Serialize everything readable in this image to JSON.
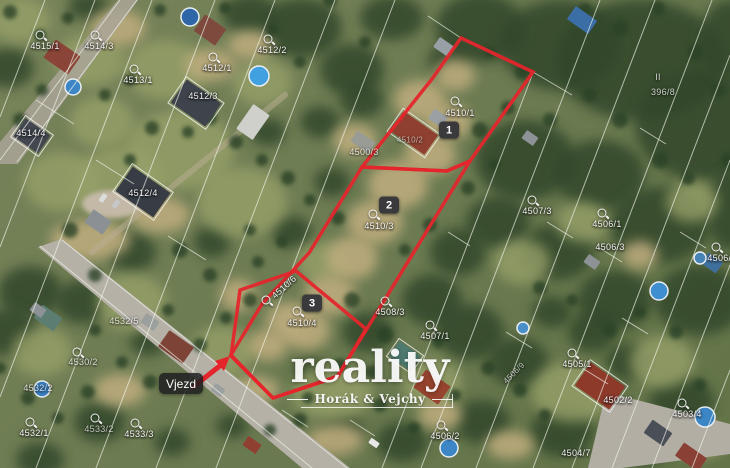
{
  "map": {
    "entrance_label": "Vjezd",
    "watermark": {
      "brand": "reality",
      "subtitle": "Horák & Vejchy"
    },
    "red_color": "#e4262c",
    "markers": [
      {
        "id": "1",
        "x": 449,
        "y": 130
      },
      {
        "id": "2",
        "x": 389,
        "y": 205
      },
      {
        "id": "3",
        "x": 312,
        "y": 303
      }
    ],
    "outlines": [
      {
        "points": "461,38 533,72 470,161 447,171 362,167 432,79"
      },
      {
        "points": "362,167 447,171 470,161 417,247 368,327 337,377 273,398 231,355 262,304 309,253"
      },
      {
        "points": "296,271 240,290 231,356 273,398 338,376 366,329"
      }
    ],
    "arrow": {
      "x1": 193,
      "y1": 387,
      "x2": 221,
      "y2": 365,
      "head": "230,356 215,361 224,371"
    },
    "parcel_labels": [
      {
        "text": "4515/1",
        "x": 45,
        "y": 46,
        "sym": [
          40,
          35
        ]
      },
      {
        "text": "4514/3",
        "x": 99,
        "y": 46,
        "sym": [
          95,
          35
        ]
      },
      {
        "text": "4513/1",
        "x": 138,
        "y": 80,
        "sym": [
          134,
          69
        ]
      },
      {
        "text": "4512/1",
        "x": 217,
        "y": 68,
        "sym": [
          213,
          57
        ]
      },
      {
        "text": "4512/2",
        "x": 272,
        "y": 50,
        "sym": [
          268,
          39
        ]
      },
      {
        "text": "4512/3",
        "x": 203,
        "y": 96
      },
      {
        "text": "4514/4",
        "x": 31,
        "y": 133
      },
      {
        "text": "4512/4",
        "x": 143,
        "y": 193
      },
      {
        "text": "4500/3",
        "x": 364,
        "y": 152,
        "op": 0.8
      },
      {
        "text": "4510/1",
        "x": 460,
        "y": 113,
        "sym": [
          455,
          101
        ]
      },
      {
        "text": "4510/2",
        "x": 410,
        "y": 140,
        "op": 0.6,
        "size": 8
      },
      {
        "text": "4510/3",
        "x": 379,
        "y": 226,
        "sym": [
          373,
          214
        ]
      },
      {
        "text": "4510/6",
        "x": 284,
        "y": 287,
        "rot": -42,
        "sym": [
          266,
          300
        ]
      },
      {
        "text": "4510/4",
        "x": 302,
        "y": 323,
        "sym": [
          297,
          311
        ]
      },
      {
        "text": "4508/3",
        "x": 390,
        "y": 312,
        "sym": [
          385,
          301
        ]
      },
      {
        "text": "4507/3",
        "x": 537,
        "y": 211,
        "sym": [
          532,
          200
        ]
      },
      {
        "text": "4506/1",
        "x": 607,
        "y": 224,
        "sym": [
          602,
          213
        ]
      },
      {
        "text": "4506/3",
        "x": 610,
        "y": 247
      },
      {
        "text": "4506/4",
        "x": 722,
        "y": 258,
        "sym": [
          716,
          247
        ]
      },
      {
        "text": "II",
        "x": 658,
        "y": 77,
        "op": 0.8
      },
      {
        "text": "396/8",
        "x": 663,
        "y": 92,
        "op": 0.8
      },
      {
        "text": "4507/1",
        "x": 435,
        "y": 336,
        "sym": [
          430,
          325
        ]
      },
      {
        "text": "4505/1",
        "x": 577,
        "y": 364,
        "sym": [
          572,
          353
        ]
      },
      {
        "text": "4506/9",
        "x": 514,
        "y": 373,
        "rot": -45,
        "op": 0.7,
        "size": 8
      },
      {
        "text": "4502/2",
        "x": 618,
        "y": 400
      },
      {
        "text": "4503/4",
        "x": 687,
        "y": 414,
        "sym": [
          682,
          403
        ]
      },
      {
        "text": "4504/7",
        "x": 576,
        "y": 453
      },
      {
        "text": "4532/5",
        "x": 124,
        "y": 321,
        "op": 0.8
      },
      {
        "text": "4530/2",
        "x": 83,
        "y": 362,
        "sym": [
          77,
          352
        ],
        "op": 0.8
      },
      {
        "text": "4532/2",
        "x": 38,
        "y": 388,
        "op": 0.8
      },
      {
        "text": "4532/1",
        "x": 34,
        "y": 433,
        "sym": [
          30,
          422
        ]
      },
      {
        "text": "4533/2",
        "x": 99,
        "y": 429,
        "sym": [
          95,
          418
        ],
        "op": 0.7
      },
      {
        "text": "4533/3",
        "x": 139,
        "y": 434,
        "sym": [
          135,
          423
        ]
      },
      {
        "text": "4506/2",
        "x": 445,
        "y": 436,
        "sym": [
          441,
          425
        ]
      }
    ]
  }
}
